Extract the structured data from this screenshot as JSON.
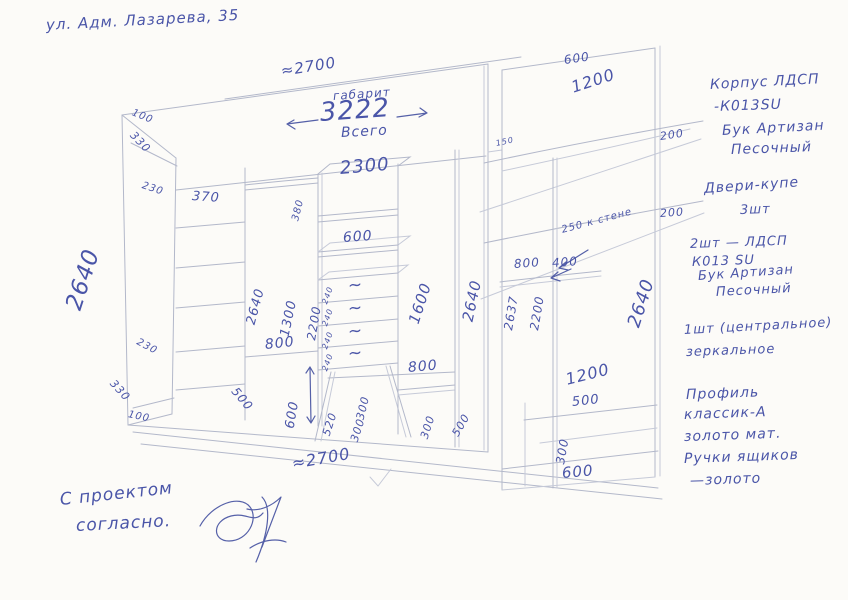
{
  "colors": {
    "paper": "#fcfbf8",
    "pen": "#4a55a8",
    "pencil": "#b3b8ca"
  },
  "drawing": {
    "labels": [
      {
        "n": "address",
        "t": "ул. Адм. Лазарева, 35",
        "x": 46,
        "y": 18,
        "r": -3,
        "s": 15
      },
      {
        "n": "dim-top-width",
        "t": "≈2700",
        "x": 281,
        "y": 64,
        "r": -9,
        "s": 15
      },
      {
        "n": "label-gabarit",
        "t": "габарит",
        "x": 333,
        "y": 90,
        "r": -4,
        "s": 12
      },
      {
        "n": "dim-overall-3222",
        "t": "3222",
        "x": 320,
        "y": 100,
        "r": -4,
        "s": 26
      },
      {
        "n": "label-vsego",
        "t": "Всего",
        "x": 341,
        "y": 126,
        "r": -3,
        "s": 14
      },
      {
        "n": "dim-interior-2300",
        "t": "2300",
        "x": 340,
        "y": 160,
        "r": -5,
        "s": 18
      },
      {
        "n": "dim-left-top-100",
        "t": "100",
        "x": 132,
        "y": 108,
        "r": 22,
        "s": 10
      },
      {
        "n": "dim-left-top-330",
        "t": "330",
        "x": 132,
        "y": 128,
        "r": 46,
        "s": 11
      },
      {
        "n": "dim-left-230-top",
        "t": "230",
        "x": 142,
        "y": 181,
        "r": 18,
        "s": 10
      },
      {
        "n": "dim-shelf-370",
        "t": "370",
        "x": 192,
        "y": 190,
        "r": 4,
        "s": 13
      },
      {
        "n": "dim-height-2640-left",
        "t": "2640",
        "x": 74,
        "y": 298,
        "r": -72,
        "s": 23
      },
      {
        "n": "dim-left-230-bottom",
        "t": "230",
        "x": 137,
        "y": 337,
        "r": 28,
        "s": 10
      },
      {
        "n": "dim-left-330-bottom",
        "t": "330",
        "x": 112,
        "y": 376,
        "r": 48,
        "s": 11
      },
      {
        "n": "dim-left-bottom-100",
        "t": "100",
        "x": 128,
        "y": 410,
        "r": 12,
        "s": 10
      },
      {
        "n": "dim-height-2640-inner",
        "t": "2640",
        "x": 251,
        "y": 318,
        "r": -75,
        "s": 13
      },
      {
        "n": "dim-hang-1300",
        "t": "1300",
        "x": 285,
        "y": 330,
        "r": -78,
        "s": 13
      },
      {
        "n": "dim-800-hang",
        "t": "800",
        "x": 265,
        "y": 338,
        "r": -6,
        "s": 14
      },
      {
        "n": "dim-500-left-leg",
        "t": "500",
        "x": 234,
        "y": 383,
        "r": 50,
        "s": 12
      },
      {
        "n": "dim-600-arrow",
        "t": "600",
        "x": 290,
        "y": 422,
        "r": -80,
        "s": 13
      },
      {
        "n": "dim-520",
        "t": "520",
        "x": 326,
        "y": 430,
        "r": -72,
        "s": 11
      },
      {
        "n": "dim-380",
        "t": "380",
        "x": 296,
        "y": 216,
        "r": -76,
        "s": 10
      },
      {
        "n": "dim-2200-center",
        "t": "2200",
        "x": 311,
        "y": 334,
        "r": -80,
        "s": 12
      },
      {
        "n": "dim-600-center",
        "t": "600",
        "x": 343,
        "y": 231,
        "r": -4,
        "s": 14
      },
      {
        "n": "dim-drawer-240-1",
        "t": "240",
        "x": 325,
        "y": 300,
        "r": -70,
        "s": 8
      },
      {
        "n": "dim-drawer-240-2",
        "t": "240",
        "x": 325,
        "y": 322,
        "r": -70,
        "s": 8
      },
      {
        "n": "dim-drawer-240-3",
        "t": "240",
        "x": 325,
        "y": 345,
        "r": -70,
        "s": 8
      },
      {
        "n": "dim-drawer-240-4",
        "t": "240",
        "x": 325,
        "y": 367,
        "r": -70,
        "s": 8
      },
      {
        "n": "drawer-squiggle-1",
        "t": "~",
        "x": 348,
        "y": 278,
        "r": -5,
        "s": 17
      },
      {
        "n": "drawer-squiggle-2",
        "t": "~",
        "x": 348,
        "y": 301,
        "r": -5,
        "s": 17
      },
      {
        "n": "drawer-squiggle-3",
        "t": "~",
        "x": 348,
        "y": 324,
        "r": -5,
        "s": 17
      },
      {
        "n": "drawer-squiggle-4",
        "t": "~",
        "x": 348,
        "y": 346,
        "r": -5,
        "s": 17
      },
      {
        "n": "dim-300-center-a",
        "t": "300",
        "x": 360,
        "y": 414,
        "r": -76,
        "s": 11
      },
      {
        "n": "dim-300-center-b",
        "t": "300",
        "x": 354,
        "y": 436,
        "r": -72,
        "s": 11
      },
      {
        "n": "dim-300-center-c",
        "t": "300",
        "x": 424,
        "y": 433,
        "r": -72,
        "s": 11
      },
      {
        "n": "dim-500-right-leg",
        "t": "500",
        "x": 455,
        "y": 430,
        "r": -60,
        "s": 11
      },
      {
        "n": "dim-1600",
        "t": "1600",
        "x": 414,
        "y": 316,
        "r": -72,
        "s": 15
      },
      {
        "n": "dim-800-right",
        "t": "800",
        "x": 408,
        "y": 361,
        "r": -5,
        "s": 14
      },
      {
        "n": "dim-2640-right-inner",
        "t": "2640",
        "x": 468,
        "y": 314,
        "r": -78,
        "s": 15
      },
      {
        "n": "dim-bottom-width",
        "t": "≈2700",
        "x": 292,
        "y": 456,
        "r": -10,
        "s": 16
      },
      {
        "n": "dim-600-unit-top",
        "t": "600",
        "x": 564,
        "y": 54,
        "r": -8,
        "s": 12
      },
      {
        "n": "dim-1200-unit-top",
        "t": "1200",
        "x": 572,
        "y": 80,
        "r": -18,
        "s": 16
      },
      {
        "n": "dim-150",
        "t": "150",
        "x": 496,
        "y": 140,
        "r": -12,
        "s": 8
      },
      {
        "n": "dim-200-a",
        "t": "200",
        "x": 660,
        "y": 131,
        "r": -8,
        "s": 11
      },
      {
        "n": "dim-200-b",
        "t": "200",
        "x": 660,
        "y": 208,
        "r": -4,
        "s": 11
      },
      {
        "n": "note-250-wall",
        "t": "250 к стене",
        "x": 562,
        "y": 226,
        "r": -15,
        "s": 10
      },
      {
        "n": "dim-800-unit",
        "t": "800",
        "x": 514,
        "y": 258,
        "r": -4,
        "s": 12
      },
      {
        "n": "dim-400",
        "t": "400",
        "x": 552,
        "y": 257,
        "r": -4,
        "s": 12
      },
      {
        "n": "dim-2637",
        "t": "2637",
        "x": 508,
        "y": 324,
        "r": -80,
        "s": 12
      },
      {
        "n": "dim-2200-unit",
        "t": "2200",
        "x": 534,
        "y": 324,
        "r": -80,
        "s": 12
      },
      {
        "n": "dim-2640-unit",
        "t": "2640",
        "x": 634,
        "y": 318,
        "r": -72,
        "s": 18
      },
      {
        "n": "dim-1200-unit-bottom",
        "t": "1200",
        "x": 566,
        "y": 372,
        "r": -14,
        "s": 16
      },
      {
        "n": "dim-500-unit",
        "t": "500",
        "x": 572,
        "y": 396,
        "r": -6,
        "s": 13
      },
      {
        "n": "dim-300-unit",
        "t": "300",
        "x": 560,
        "y": 458,
        "r": -80,
        "s": 12
      },
      {
        "n": "dim-600-unit-bottom",
        "t": "600",
        "x": 562,
        "y": 466,
        "r": -5,
        "s": 15
      },
      {
        "n": "note-body-material-1",
        "t": "Корпус ЛДСП",
        "x": 710,
        "y": 78,
        "r": -3,
        "s": 14
      },
      {
        "n": "note-body-material-2",
        "t": "-К013SU",
        "x": 714,
        "y": 100,
        "r": -2,
        "s": 14
      },
      {
        "n": "note-body-material-3",
        "t": "Бук Артизан",
        "x": 722,
        "y": 124,
        "r": -3,
        "s": 14
      },
      {
        "n": "note-body-material-4",
        "t": "Песочный",
        "x": 731,
        "y": 143,
        "r": -2,
        "s": 14
      },
      {
        "n": "note-doors-1",
        "t": "Двери-купе",
        "x": 704,
        "y": 182,
        "r": -4,
        "s": 14
      },
      {
        "n": "note-doors-2",
        "t": "3шт",
        "x": 740,
        "y": 204,
        "r": -2,
        "s": 13
      },
      {
        "n": "note-door-material-1",
        "t": "2шт — ЛДСП",
        "x": 690,
        "y": 238,
        "r": -2,
        "s": 13
      },
      {
        "n": "note-door-material-2",
        "t": "К013 SU",
        "x": 692,
        "y": 256,
        "r": -2,
        "s": 13
      },
      {
        "n": "note-door-material-3",
        "t": "Бук Артизан",
        "x": 698,
        "y": 270,
        "r": -4,
        "s": 13
      },
      {
        "n": "note-door-material-4",
        "t": "Песочный",
        "x": 716,
        "y": 286,
        "r": -3,
        "s": 13
      },
      {
        "n": "note-mirror-1",
        "t": "1шт (центральное)",
        "x": 684,
        "y": 324,
        "r": -3,
        "s": 13
      },
      {
        "n": "note-mirror-2",
        "t": "зеркальное",
        "x": 686,
        "y": 346,
        "r": -2,
        "s": 13
      },
      {
        "n": "note-profile-1",
        "t": "Профиль",
        "x": 686,
        "y": 388,
        "r": -2,
        "s": 14
      },
      {
        "n": "note-profile-2",
        "t": "классик-А",
        "x": 684,
        "y": 408,
        "r": -2,
        "s": 14
      },
      {
        "n": "note-profile-3",
        "t": "золото мат.",
        "x": 684,
        "y": 430,
        "r": -2,
        "s": 14
      },
      {
        "n": "note-handles-1",
        "t": "Ручки ящиков",
        "x": 684,
        "y": 452,
        "r": -2,
        "s": 14
      },
      {
        "n": "note-handles-2",
        "t": "—золото",
        "x": 690,
        "y": 474,
        "r": -2,
        "s": 14
      },
      {
        "n": "approval-line-1",
        "t": "С проектом",
        "x": 60,
        "y": 492,
        "r": -6,
        "s": 17
      },
      {
        "n": "approval-line-2",
        "t": "согласно.",
        "x": 76,
        "y": 518,
        "r": -3,
        "s": 17
      }
    ]
  }
}
